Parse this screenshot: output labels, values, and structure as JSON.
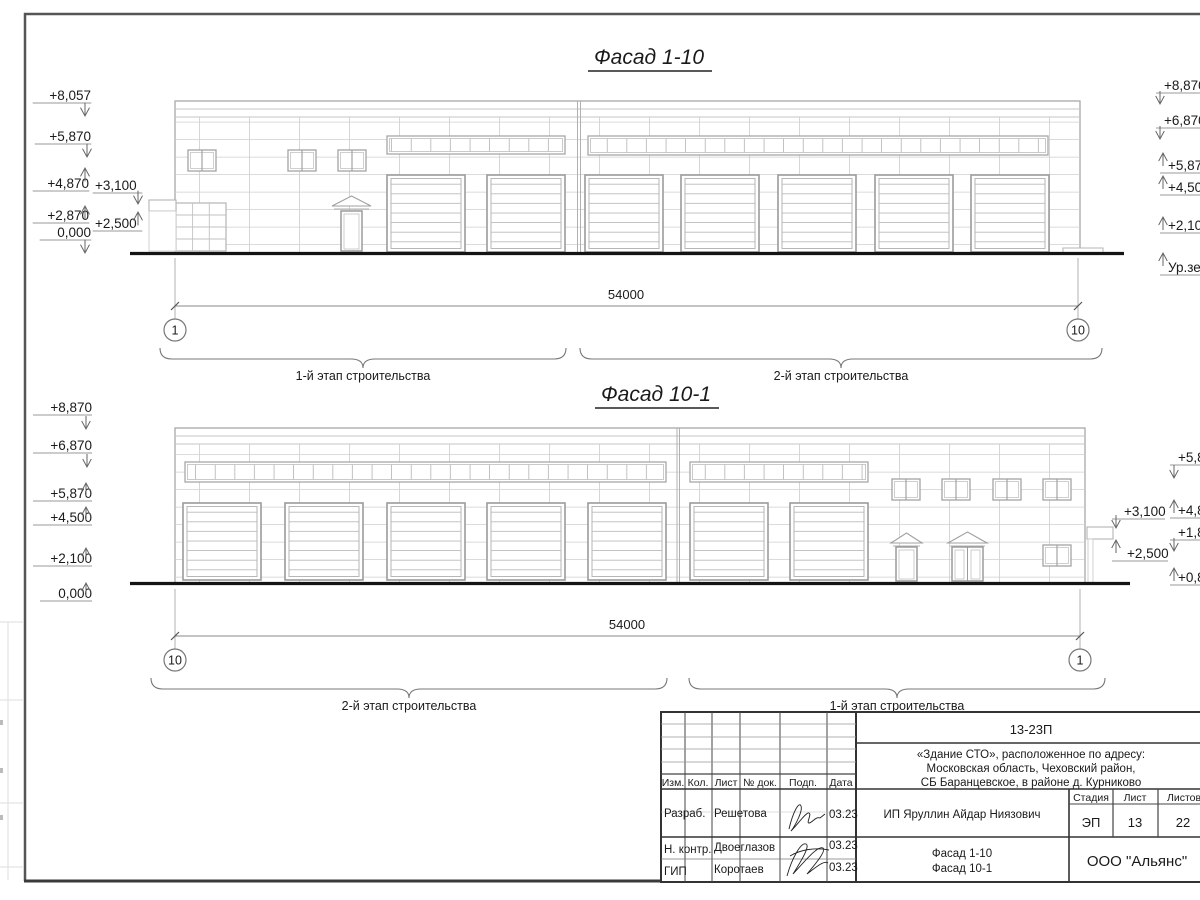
{
  "colors": {
    "ink": "#1a1a1a",
    "drawing_line": "#b5b5b5",
    "frame": "#4a4a4a"
  },
  "facade_top": {
    "title": "Фасад 1-10",
    "dimension": "54000",
    "axis_left": "1",
    "axis_right": "10",
    "stage_left": "1-й этап строительства",
    "stage_right": "2-й этап строительства",
    "marks_left": [
      "+8,057",
      "+5,870",
      "+4,870",
      "+2,870",
      "0,000"
    ],
    "marks_inner": [
      "+3,100",
      "+2,500"
    ],
    "marks_right": [
      "+8,870",
      "+6,870",
      "+5,87",
      "+4,50",
      "+2,10",
      "Ур.зе"
    ]
  },
  "facade_bottom": {
    "title": "Фасад 10-1",
    "dimension": "54000",
    "axis_left": "10",
    "axis_right": "1",
    "stage_left": "2-й этап строительства",
    "stage_right": "1-й этап строительства",
    "marks_left": [
      "+8,870",
      "+6,870",
      "+5,870",
      "+4,500",
      "+2,100",
      "0,000"
    ],
    "marks_inner": [
      "+3,100",
      "+2,500"
    ],
    "marks_right": [
      "+5,8",
      "+4,8",
      "+1,8",
      "+0,8"
    ]
  },
  "title_block": {
    "doc_number": "13-23П",
    "address_lines": [
      "«Здание СТО», расположенное по адресу:",
      "Московская область, Чеховский район,",
      "СБ Баранцевское, в районе д. Курниково"
    ],
    "client": "ИП Яруллин Айдар Ниязович",
    "columns": [
      "Изм.",
      "Кол.",
      "Лист",
      "№ док.",
      "Подп.",
      "Дата"
    ],
    "signers": [
      {
        "role": "Разраб.",
        "name": "Решетова",
        "date": "03.23"
      },
      {
        "role": "Н. контр.",
        "name": "Двоеглазов",
        "date": "03.23"
      },
      {
        "role": "ГИП",
        "name": "Коротаев",
        "date": "03.23"
      }
    ],
    "stage": {
      "label": "Стадия",
      "value": "ЭП"
    },
    "sheet": {
      "label": "Лист",
      "value": "13"
    },
    "sheets": {
      "label": "Листов",
      "value": "22"
    },
    "sheet_titles": [
      "Фасад 1-10",
      "Фасад 10-1"
    ],
    "company": "ООО \"Альянс\""
  }
}
